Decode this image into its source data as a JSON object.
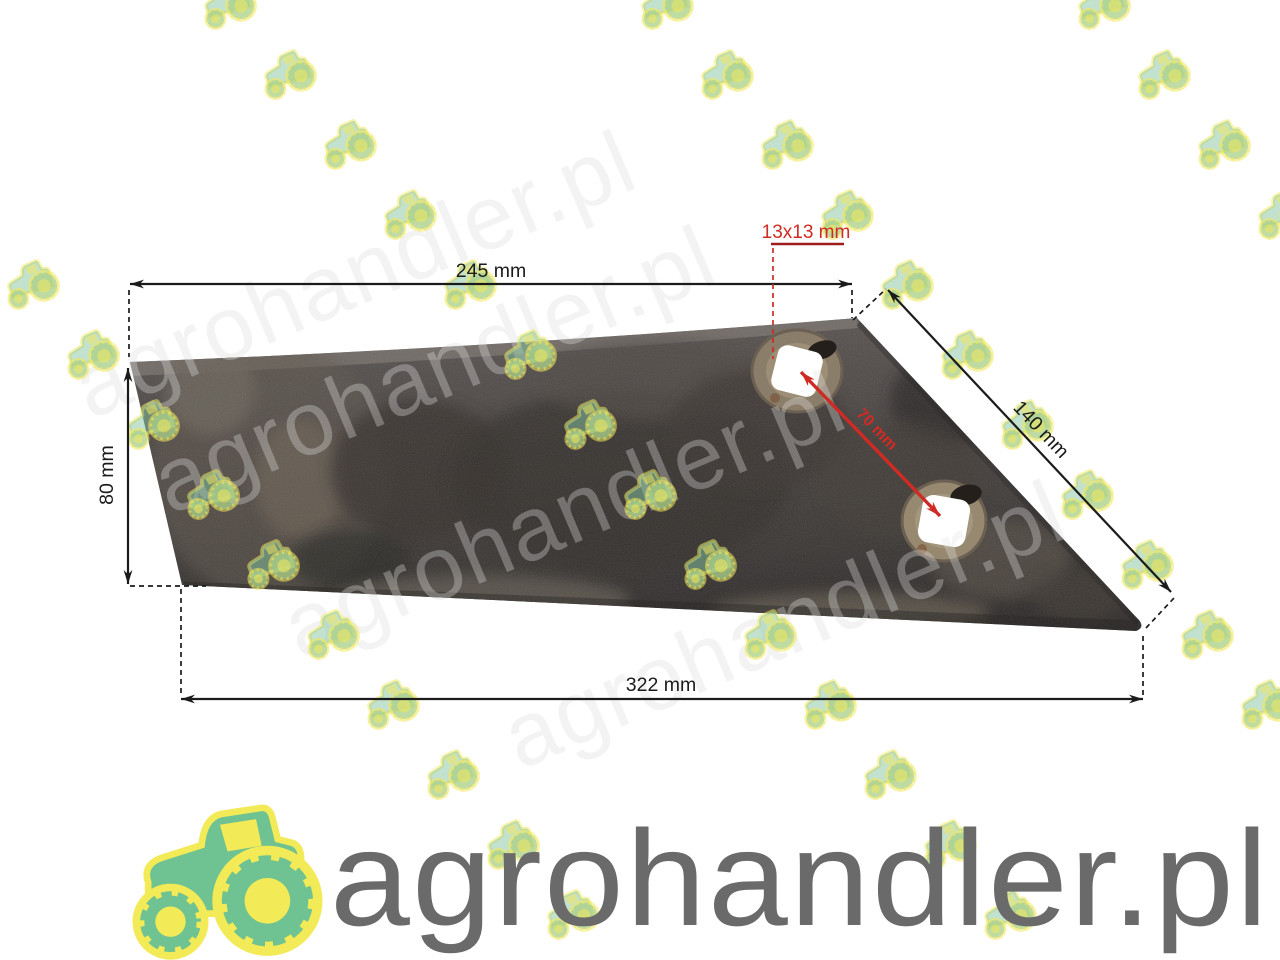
{
  "watermark": {
    "brand": "agrohandler.pl"
  },
  "logo": {
    "text": "agrohandler.pl",
    "text_color": "#6a6a6a",
    "tractor_green": "#6fc291",
    "tractor_yellow": "#f2ea57"
  },
  "dimensions": {
    "top_width": "245 mm",
    "left_height": "80 mm",
    "bottom_width": "322 mm",
    "edge_length": "140 mm",
    "hole_size": "13x13 mm",
    "hole_spacing": "70 mm"
  },
  "colors": {
    "dimension": "#1b1b1b",
    "annotation_red": "#cf2b24",
    "underline_red": "#9e1c1c"
  }
}
